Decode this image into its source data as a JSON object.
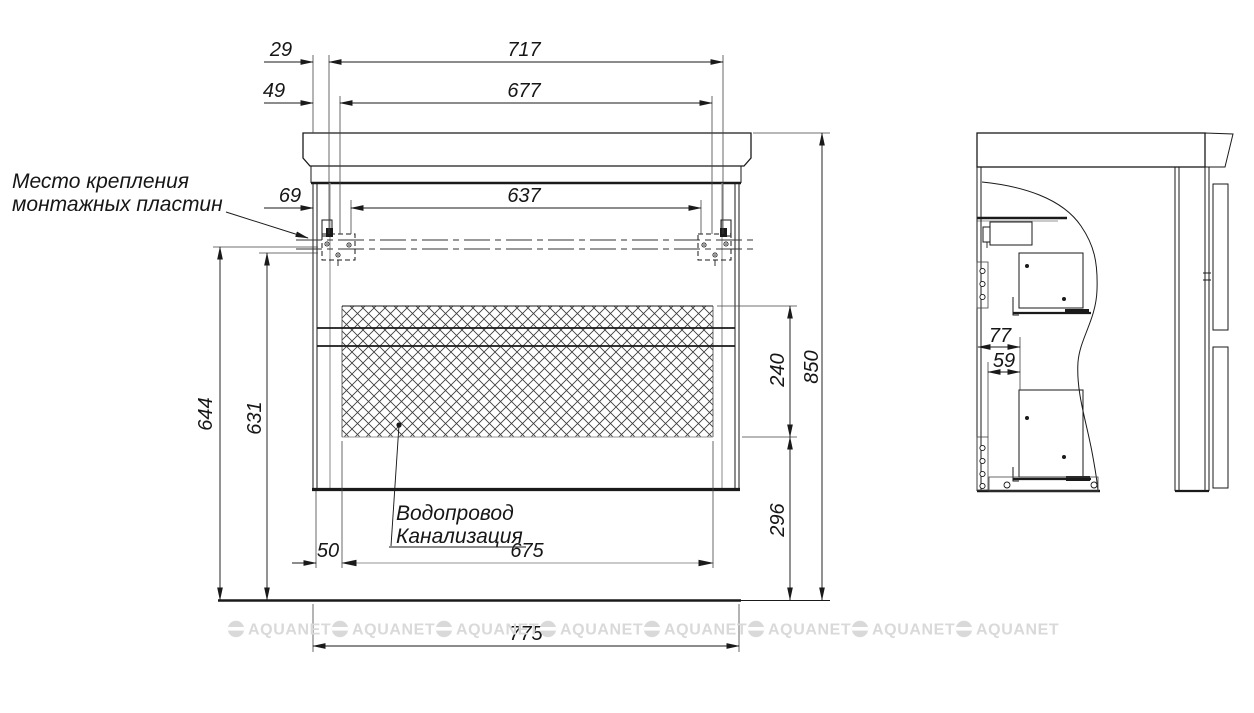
{
  "notes": {
    "mounting": {
      "line1": "Место крепления",
      "line2": "монтажных пластин"
    },
    "plumbing": {
      "line1": "Водопровод",
      "line2": "Канализация"
    }
  },
  "dims": {
    "d29": "29",
    "d49": "49",
    "d69": "69",
    "d717": "717",
    "d677": "677",
    "d637": "637",
    "d644": "644",
    "d631": "631",
    "d240": "240",
    "d296": "296",
    "d850": "850",
    "d50": "50",
    "d675": "675",
    "d775": "775",
    "d77": "77",
    "d59": "59"
  },
  "watermark": {
    "text": "AQUANET",
    "repeat": 8
  },
  "colors": {
    "line": "#1a1a1a",
    "thin": "#444444",
    "gray": "#949494",
    "hatch": "#3c3c3c",
    "watermark": "#d9d9d9",
    "bg": "#ffffff"
  }
}
